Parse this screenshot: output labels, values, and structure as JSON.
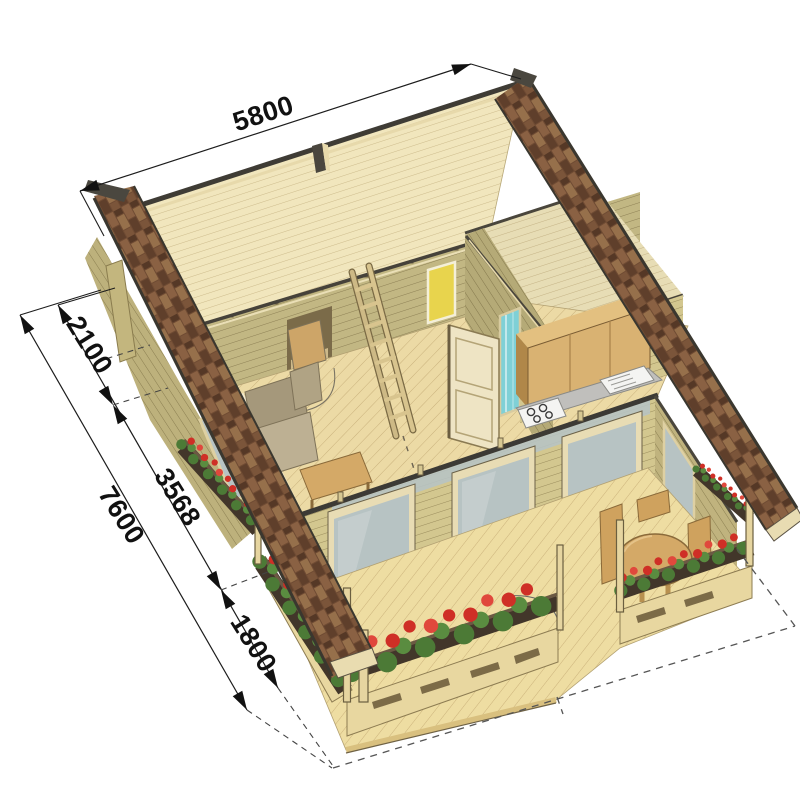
{
  "figure": {
    "kind": "axonometric-cabin-cutaway",
    "description": "3D cutaway plan of a log cabin with loft ceiling, kitchen, shower, ladder and flower-box veranda"
  },
  "dimensions": {
    "top_width_mm": "5800",
    "side_total_mm": "7600",
    "side_segments_mm": [
      "2100",
      "3568",
      "1800"
    ]
  },
  "colors": {
    "background": "#ffffff",
    "roof_shingle": "#6f4b33",
    "wall_log": "#ccbf86",
    "wall_log_front": "#d3c78f",
    "ceiling_board": "#f1e6bd",
    "floor_board": "#ecdaa5",
    "deck_board": "#eedda2",
    "glass": "#b7c3c3",
    "shower_glass": "#7fd0d6",
    "flower_red": "#cf2f26",
    "leaf_green": "#4c7a36",
    "planter_brown": "#42362a",
    "furniture_wood": "#d4a967",
    "counter_gray": "#c0bfbc",
    "dimension_line": "#1c1c1c"
  }
}
